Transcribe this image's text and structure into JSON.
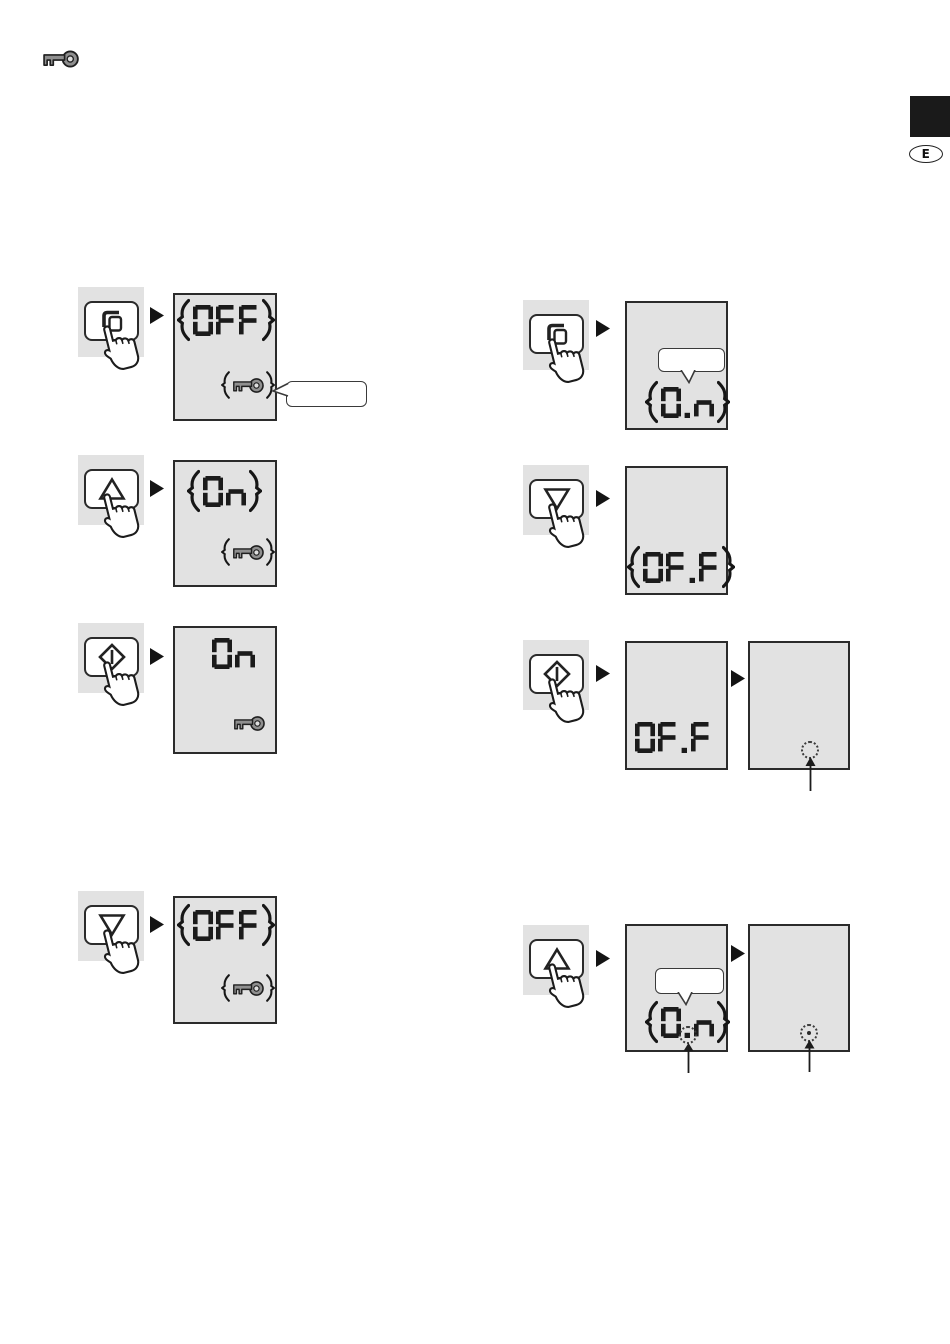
{
  "header": {
    "icon": "key-icon"
  },
  "page_markers": {
    "language_badge": "E"
  },
  "colors": {
    "panel_bg": "#e2e2e2",
    "ink": "#1b1b1b",
    "key_fill": "#8f8f8f",
    "tab_black": "#1a1a1a"
  },
  "left_steps": [
    {
      "button": "mode-button",
      "display": {
        "value": "OFF",
        "blinking": true,
        "key_icon": "blinking",
        "callout_label": ""
      }
    },
    {
      "button": "up-button",
      "display": {
        "value": "On",
        "blinking": true,
        "key_icon": "blinking"
      }
    },
    {
      "button": "start-button",
      "display": {
        "value": "On",
        "blinking": false,
        "key_icon": "steady"
      }
    },
    {
      "button": "down-button",
      "display": {
        "value": "OFF",
        "blinking": true,
        "key_icon": "blinking"
      }
    }
  ],
  "right_steps": [
    {
      "button": "mode-button",
      "display1": {
        "callout_label": "",
        "value": "0.n",
        "blinking": true
      }
    },
    {
      "button": "down-button",
      "display1": {
        "value": "OF.F",
        "blinking": true
      }
    },
    {
      "button": "start-button",
      "display1": {
        "value": "OF.F",
        "blinking": false
      },
      "display2": {
        "highlight": "dotted-circle",
        "pointer_arrow": true
      }
    },
    {
      "button": "up-button",
      "display1": {
        "callout_label": "",
        "value": "0.n",
        "blinking": true,
        "highlight": "dotted-circle-on-decimal-point",
        "pointer_arrow": true
      },
      "display2": {
        "highlight": "dotted-circle-with-dot",
        "pointer_arrow": true
      }
    }
  ]
}
